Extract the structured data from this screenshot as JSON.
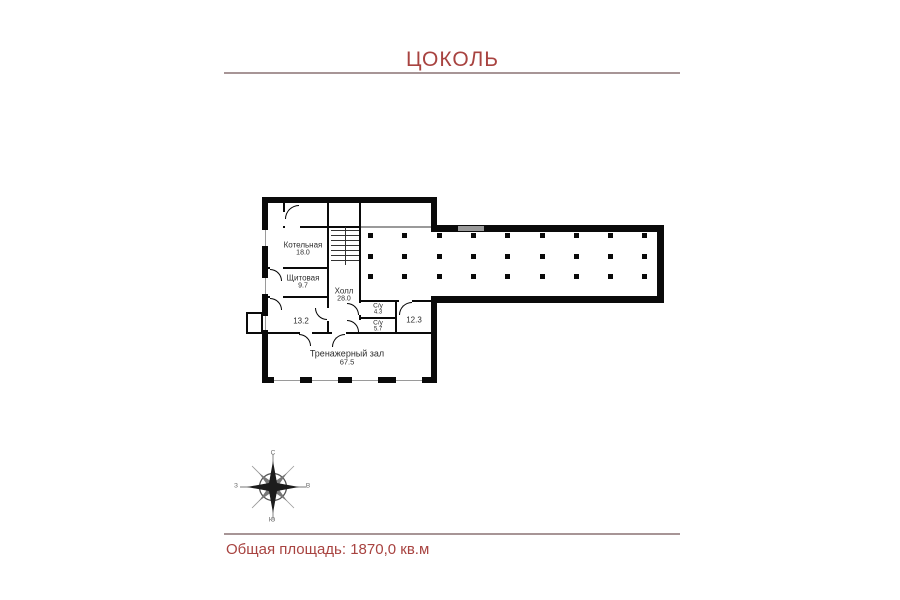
{
  "page": {
    "title": "ЦОКОЛЬ",
    "footer_text": "Общая площадь: 1870,0 кв.м"
  },
  "colors": {
    "accent_red": "#a84340",
    "rule_gray": "#a79596",
    "wall_black": "#0a0a0a"
  },
  "rooms": [
    {
      "name": "Котельная",
      "area": "18.0"
    },
    {
      "name": "Щитовая",
      "area": "9.7"
    },
    {
      "name": "Холл",
      "area": "28.0"
    },
    {
      "name": "",
      "area": "13.2"
    },
    {
      "name": "С/у",
      "area": "4.3"
    },
    {
      "name": "С/у",
      "area": "5.7"
    },
    {
      "name": "",
      "area": "12.3"
    },
    {
      "name": "Тренажерный зал",
      "area": "67.5"
    }
  ],
  "compass": {
    "n": "С",
    "s": "Ю",
    "w": "З",
    "e": "В"
  },
  "floorplan": {
    "column_grid": {
      "cols": 9,
      "rows": 3
    },
    "stair_treads": 7,
    "bottom_window_x": [
      274,
      312,
      352,
      396
    ],
    "left_window_y": [
      230,
      278
    ]
  }
}
